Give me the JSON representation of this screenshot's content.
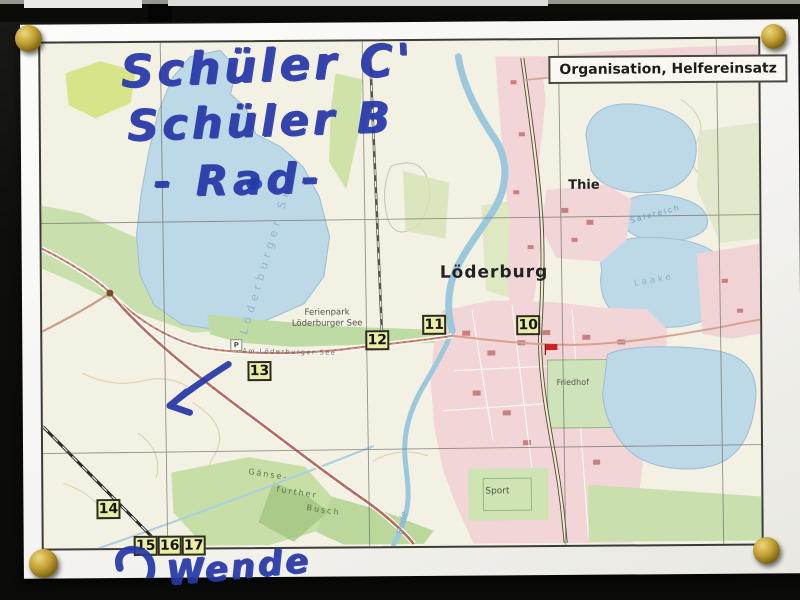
{
  "title_box": {
    "label": "Organisation, Helfereinsatz"
  },
  "handwriting": {
    "line1": "Schüler C'",
    "line2": "Schüler B",
    "line3": "- Rad-",
    "turnaround": "Wende"
  },
  "waypoints": [
    "10",
    "11",
    "12",
    "13",
    "14",
    "15",
    "16",
    "17"
  ],
  "map_labels": {
    "town": "Löderburg",
    "village": "Thie",
    "ferienpark_line1": "Ferienpark",
    "ferienpark_line2": "Löderburger See",
    "street": "Am Löderburger See",
    "lake": "Löderburger See",
    "pond_ne": "Salzteich",
    "pond_e": "Laake",
    "cemetery": "Friedhof",
    "sports": "Sport",
    "forest_line1": "Gänse-",
    "forest_line2": "further",
    "forest_line3": "Busch",
    "river": "Bode",
    "parking": "P"
  },
  "colors": {
    "marker_blue": "#2638a8",
    "pin_gold": "#c3a135",
    "water": "#bdd8e6",
    "town_pink": "#f2d5d6",
    "forest_green": "#cde0ac",
    "waypoint_yellow": "#e9eda5",
    "paper_white": "#f6f4ee",
    "board_dark": "#12120f"
  }
}
